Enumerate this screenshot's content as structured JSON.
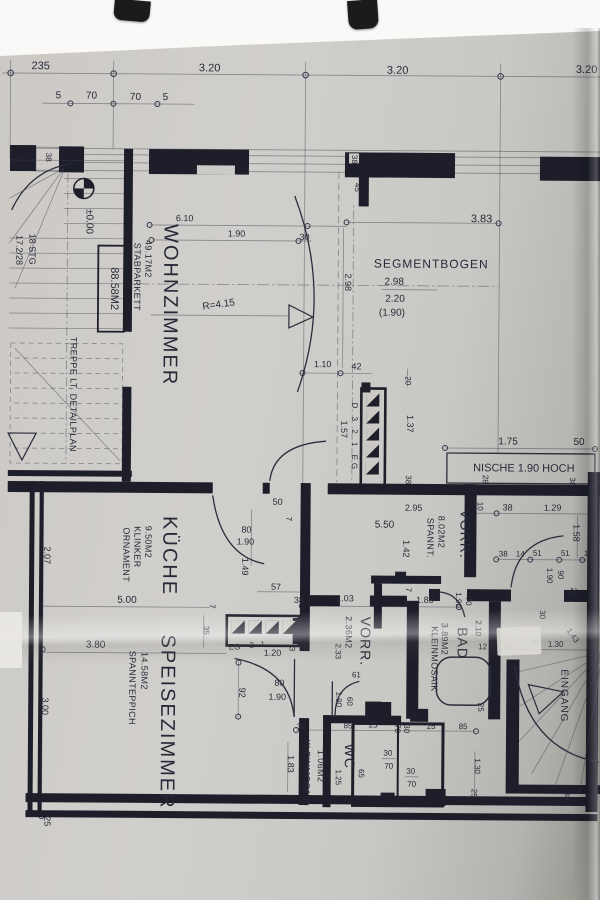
{
  "rooms": {
    "wohnzimmer": {
      "name": "WOHNZIMMER",
      "area": "49.17M2",
      "floor": "STABPARKETT",
      "total": "88.58M2"
    },
    "kueche": {
      "name": "KÜCHE",
      "area": "9.50M2",
      "floor_line1": "KLINKER",
      "floor_line2": "ORNAMENT"
    },
    "speisezimmer": {
      "name": "SPEISEZIMMER",
      "area": "14.58M2",
      "floor": "SPANNTEPPICH"
    },
    "vorraum_gross": {
      "name": "VORR.",
      "area": "8.02M2",
      "floor": "SPANNT."
    },
    "vorraum_klein": {
      "name": "VORR.",
      "area": "2.36M2"
    },
    "bad": {
      "name": "BAD",
      "area": "3.89M2",
      "floor": "KLEINMOSAIK"
    },
    "wc": {
      "name": "WC",
      "area": "1.06M2",
      "floor": "KLEINMOSAIK"
    },
    "eingang": {
      "name": "EINGANG"
    }
  },
  "notes": {
    "treppe": "TREPPE LT. DETAILPLAN",
    "stg_line1": "18 STG",
    "stg_line2": "17.2/28",
    "level": "±0.00",
    "segmentbogen": "SEGMENTBOGEN",
    "seg_v1": "2.98",
    "seg_v2": "2.20",
    "seg_v3": "(1.90)",
    "nische": "NISCHE 1.90 HOCH",
    "radius": "R=4.15",
    "steps_vertical": "D 3 2 1 EG",
    "steps_eg": "EG",
    "step_2": "2",
    "step_1": "1",
    "step_3": "3"
  },
  "dims": {
    "t235": "235",
    "t320a": "3.20",
    "t320b": "3.20",
    "t320c": "3.20",
    "s5a": "5",
    "s70a": "70",
    "s70b": "70",
    "s5b": "5",
    "w38_tl": "38",
    "w38_mid": "38",
    "w45": "45",
    "wz610": "6.10",
    "wz190": "1.90",
    "wz30": "30",
    "wz298": "2.98",
    "wz383": "3.83",
    "wz110": "1.10",
    "a42": "42",
    "a20": "20",
    "a157": "1.57",
    "a137": "1.37",
    "a38": "38",
    "n175": "1.75",
    "n50": "50",
    "n28": "28",
    "n38a": "38",
    "n10": "10",
    "n38h": "38",
    "n129": "1.29",
    "n158": "1.58",
    "r38": "38",
    "r14": "14",
    "r51a": "51",
    "r51b": "51",
    "r13": "13",
    "r190": "1.90",
    "r90": "90",
    "r25": "25",
    "r30": "30",
    "r83": "83",
    "r130": "1.30",
    "r143": "1.43",
    "r26": "26.",
    "r38b": "38",
    "k50": "50",
    "k7a": "7",
    "k80": "80",
    "k190": "1.90",
    "k149": "1.49",
    "k57": "57",
    "k500": "5.00",
    "k7b": "7",
    "v295": "2.95",
    "v550": "5.50",
    "v142": "1.42",
    "v7": "7",
    "m38": "38",
    "m103": "1.03",
    "m7": "7",
    "m185": "1.85",
    "m190": "1.90",
    "m70": "70",
    "m210": "2.10",
    "m12": "12",
    "m25": "25",
    "l207": "2.07",
    "l300": "3.00",
    "l25": "25",
    "l380": "3.80",
    "l35": "35",
    "sp92": "92",
    "sp80": "80",
    "sp190": "1.90",
    "sp120": "1.20",
    "v2_233": "2.33",
    "v2_61": "61",
    "v2_60": "60",
    "v2_190": "1.90",
    "wc38": "38",
    "wc85a": "85",
    "wc25a": "25",
    "wc70": "70",
    "wc30": "30",
    "wc25b": "25",
    "wc85b": "85",
    "wc30s1": "30",
    "wc70s1": "70",
    "wc30s2": "30",
    "wc70s2": "70",
    "wc65": "65",
    "wc125": "1.25",
    "wc183": "1.83",
    "br130": "1.30",
    "br25": "25"
  }
}
